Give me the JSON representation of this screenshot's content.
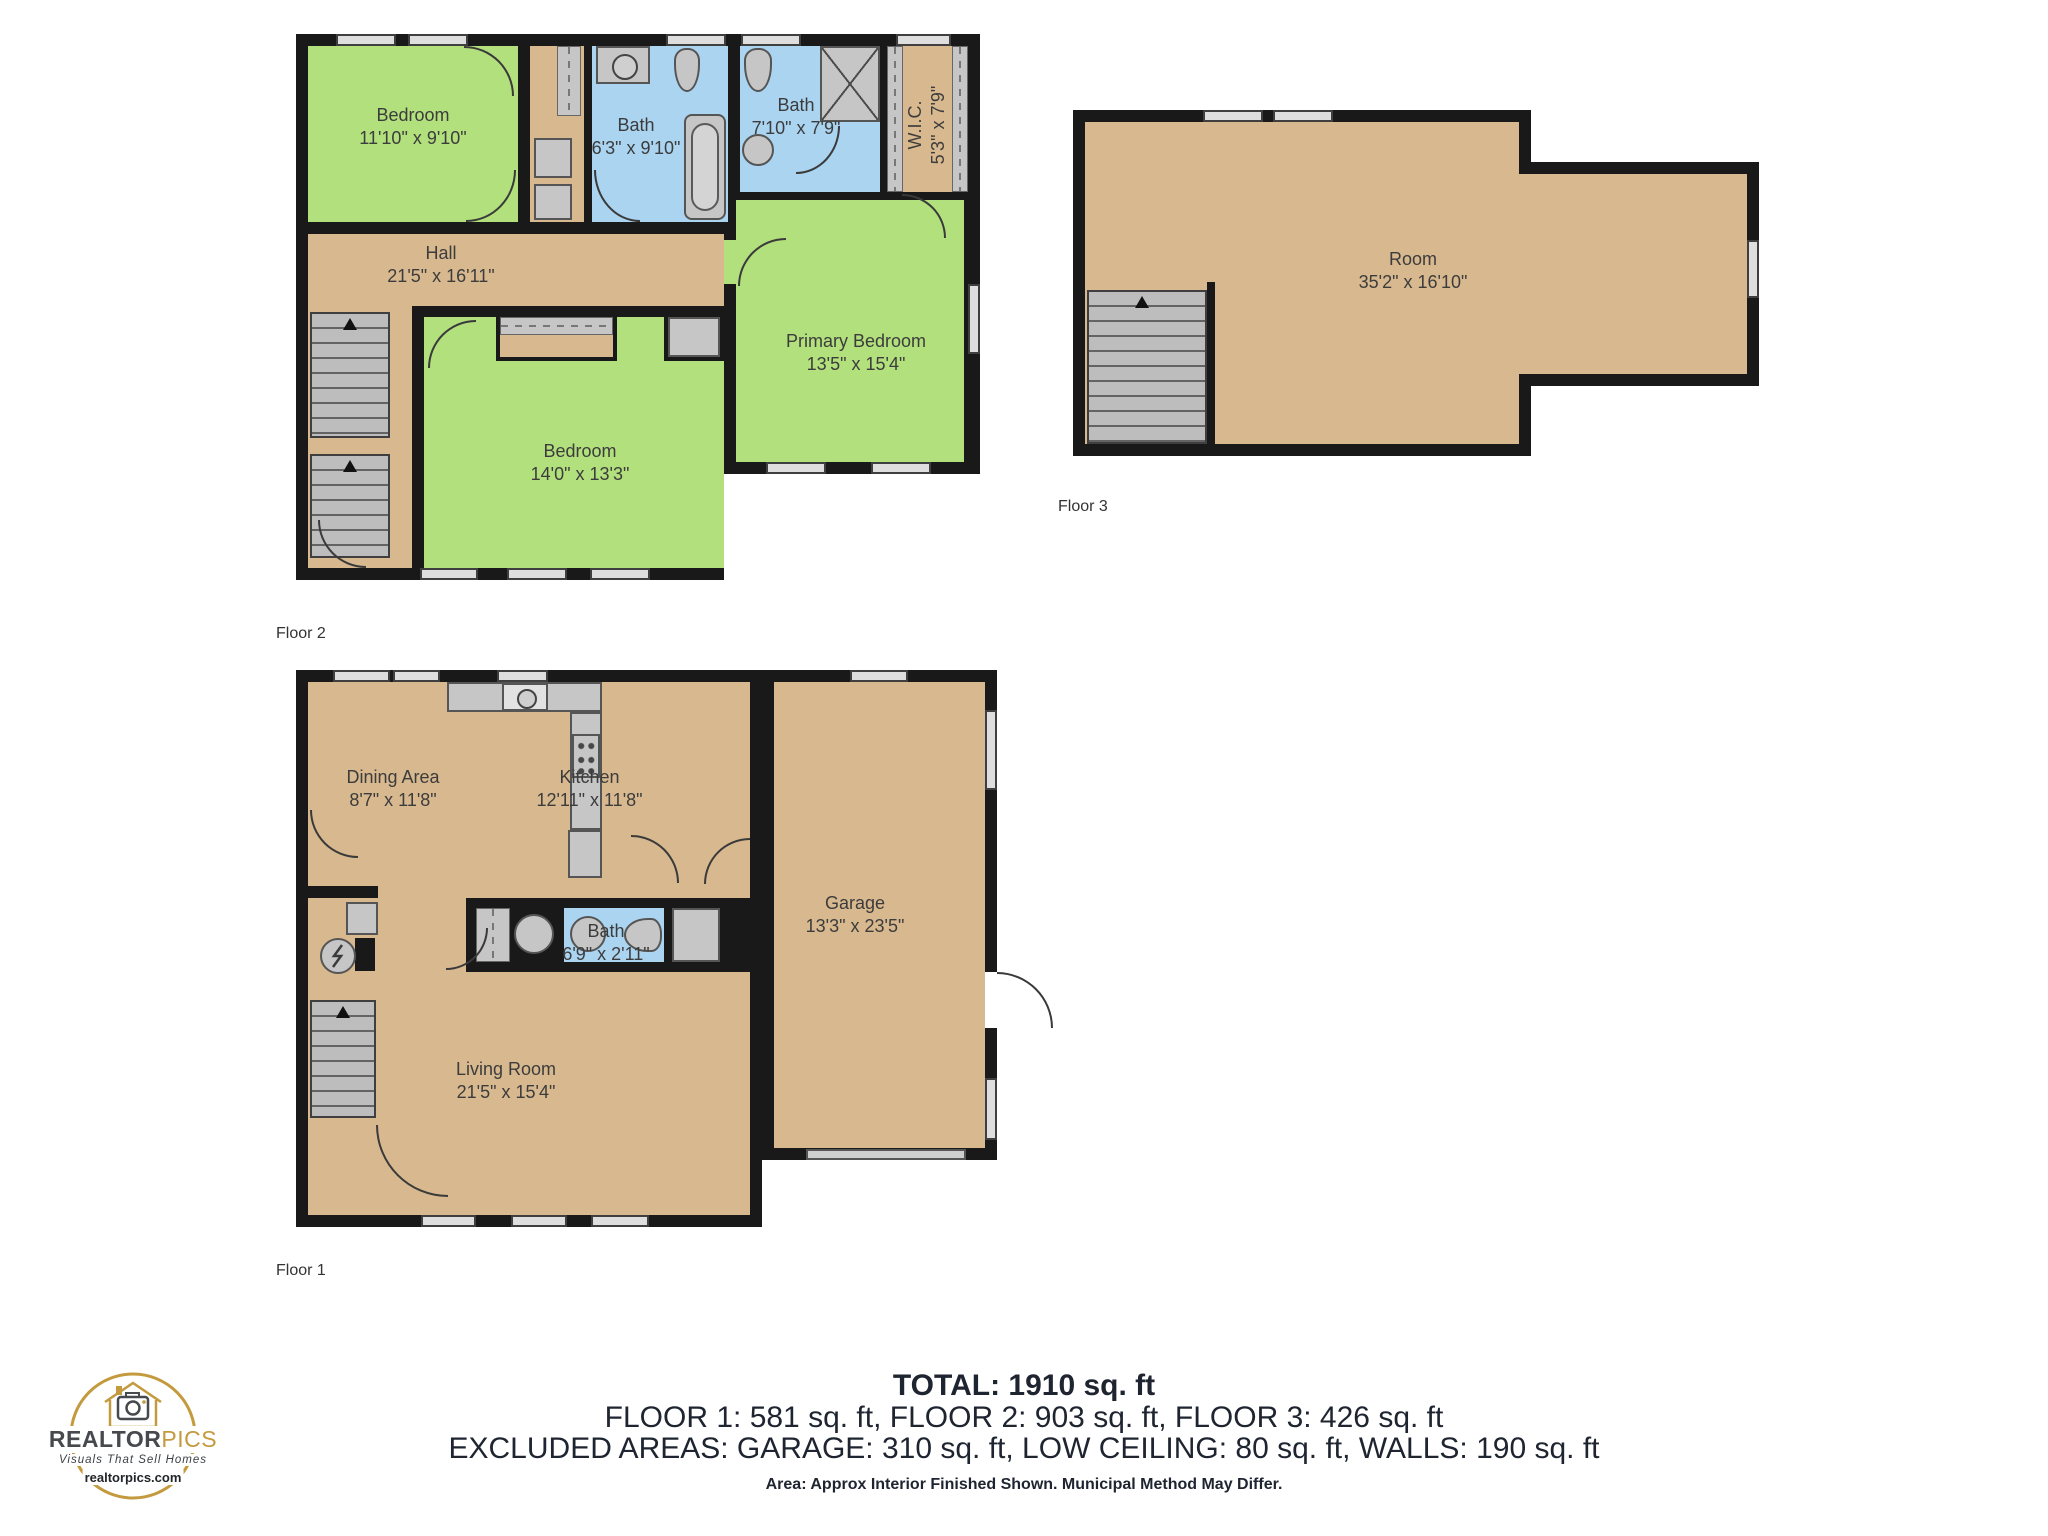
{
  "colors": {
    "green": "#b2e07d",
    "tan": "#d8b88e",
    "blue": "#aad4f0",
    "wall": "#191919",
    "logo_gold": "#c49a3e",
    "logo_dark": "#46494d"
  },
  "floor2": {
    "caption": "Floor 2",
    "rooms": [
      {
        "name": "Bedroom",
        "dims": "11'10\" x 9'10\""
      },
      {
        "name": "Bath",
        "dims": "6'3\" x 9'10\""
      },
      {
        "name": "Bath",
        "dims": "7'10\" x 7'9\""
      },
      {
        "name": "W.I.C.",
        "dims": "5'3\" x 7'9\""
      },
      {
        "name": "Hall",
        "dims": "21'5\" x 16'11\""
      },
      {
        "name": "Primary Bedroom",
        "dims": "13'5\" x 15'4\""
      },
      {
        "name": "Bedroom",
        "dims": "14'0\" x 13'3\""
      }
    ]
  },
  "floor3": {
    "caption": "Floor 3",
    "rooms": [
      {
        "name": "Room",
        "dims": "35'2\" x 16'10\""
      }
    ]
  },
  "floor1": {
    "caption": "Floor 1",
    "rooms": [
      {
        "name": "Dining Area",
        "dims": "8'7\" x 11'8\""
      },
      {
        "name": "Kitchen",
        "dims": "12'11\" x 11'8\""
      },
      {
        "name": "Bath",
        "dims": "6'9\" x 2'11\""
      },
      {
        "name": "Living Room",
        "dims": "21'5\" x 15'4\""
      },
      {
        "name": "Garage",
        "dims": "13'3\" x 23'5\""
      }
    ]
  },
  "summary": {
    "total": "TOTAL: 1910 sq. ft",
    "floors": "FLOOR 1: 581 sq. ft, FLOOR 2: 903 sq. ft, FLOOR 3: 426 sq. ft",
    "excluded": "EXCLUDED AREAS: GARAGE: 310 sq. ft, LOW CEILING: 80 sq. ft, WALLS: 190 sq. ft",
    "disclaimer": "Area: Approx Interior Finished Shown. Municipal Method May Differ."
  },
  "logo": {
    "brand_realtor": "REALTOR",
    "brand_pics": "PICS",
    "tagline": "Visuals That Sell Homes",
    "url": "realtorpics.com",
    "icon": "house-camera-icon"
  }
}
